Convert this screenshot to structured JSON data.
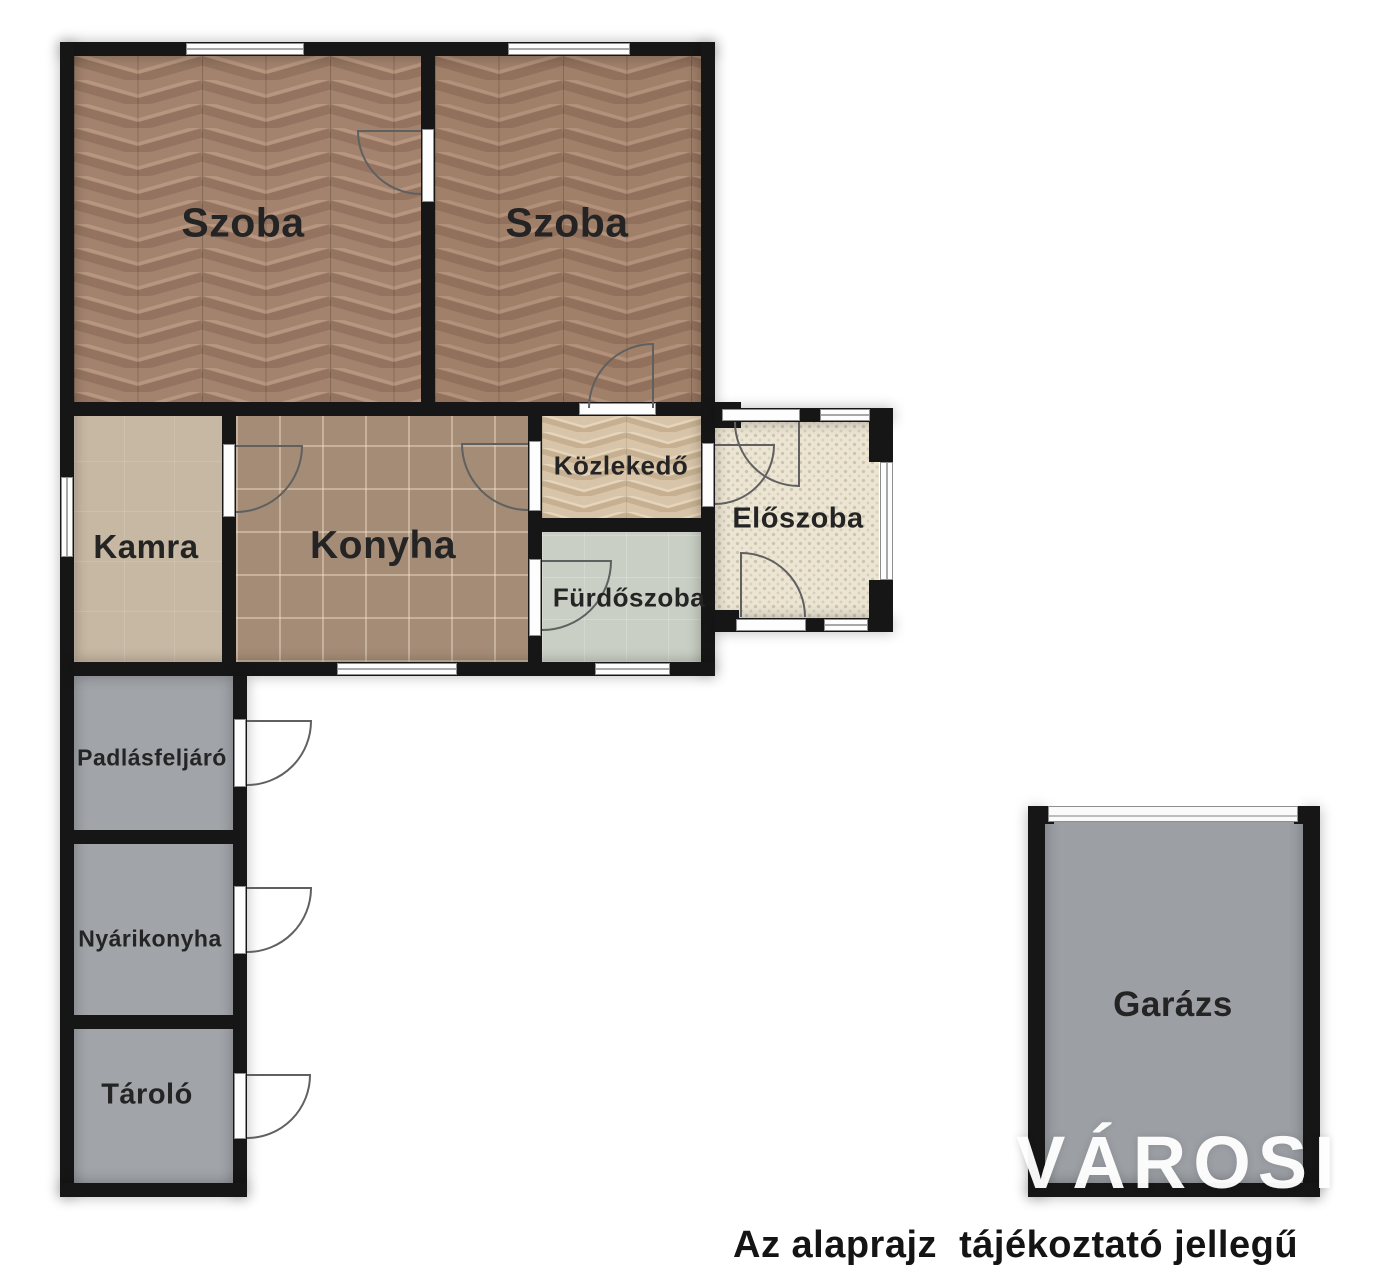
{
  "watermark": "VÁROSI",
  "disclaimer": "Az alaprajz  tájékoztató jellegű",
  "rooms": [
    {
      "id": "szoba-1",
      "label": "Szoba",
      "floor_color": "#a3836e",
      "floor_style": "herringbone-parquet"
    },
    {
      "id": "szoba-2",
      "label": "Szoba",
      "floor_color": "#a3836e",
      "floor_style": "herringbone-parquet"
    },
    {
      "id": "kamra",
      "label": "Kamra",
      "floor_color": "#c6b8a2",
      "floor_style": "plain-tile"
    },
    {
      "id": "konyha",
      "label": "Konyha",
      "floor_color": "#a58c77",
      "floor_style": "grid-tile"
    },
    {
      "id": "kozlekedo",
      "label": "Közlekedő",
      "floor_color": "#d8c5a9",
      "floor_style": "herringbone-light"
    },
    {
      "id": "furdoszoba",
      "label": "Fürdőszoba",
      "floor_color": "#c9cfc4",
      "floor_style": "plain-tile"
    },
    {
      "id": "eloszoba",
      "label": "Előszoba",
      "floor_color": "#ece5d4",
      "floor_style": "mosaic-dots"
    },
    {
      "id": "padlasfeljaro",
      "label": "Padlásfeljáró",
      "floor_color": "#a1a4a9",
      "floor_style": "plain"
    },
    {
      "id": "nyarikonyha",
      "label": "Nyárikonyha",
      "floor_color": "#a1a4a9",
      "floor_style": "plain"
    },
    {
      "id": "tarolo",
      "label": "Tároló",
      "floor_color": "#a1a4a9",
      "floor_style": "plain"
    },
    {
      "id": "garazs",
      "label": "Garázs",
      "floor_color": "#9ca0a5",
      "floor_style": "plain"
    }
  ],
  "palette": {
    "wall": "#161616",
    "window": "#fdfdfd",
    "window_frame": "#8f8f8f",
    "door_swing": "#606060",
    "label_text": "#242424",
    "background": "#ffffff",
    "watermark_color": "#ffffff"
  }
}
